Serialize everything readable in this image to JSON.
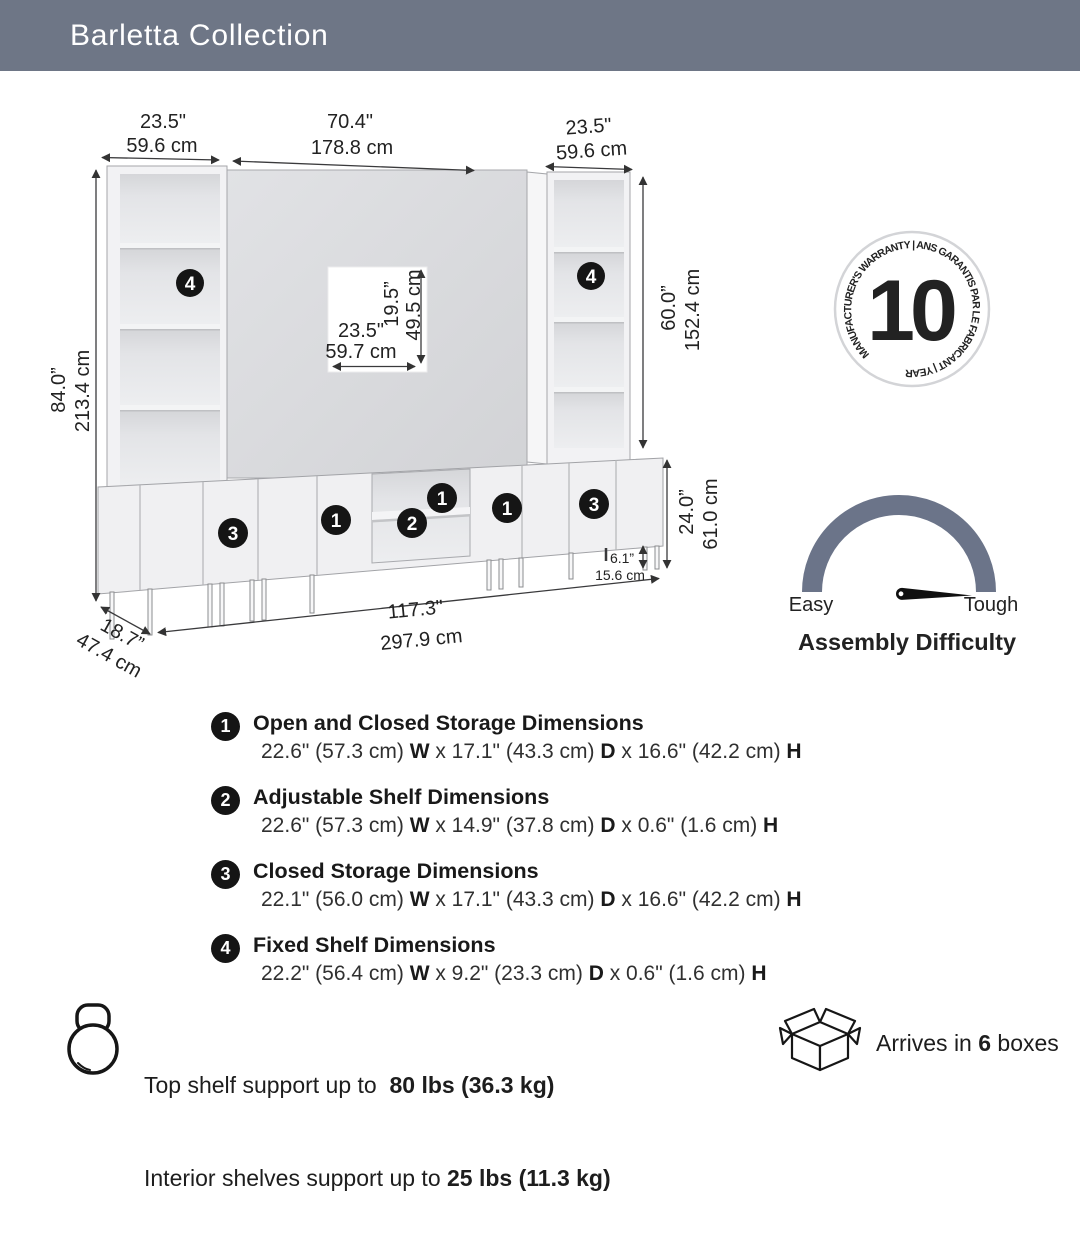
{
  "header": {
    "title": "Barletta Collection"
  },
  "diagram": {
    "dims": {
      "left_width": {
        "in": "23.5\"",
        "cm": "59.6 cm"
      },
      "center_width": {
        "in": "70.4\"",
        "cm": "178.8 cm"
      },
      "right_width": {
        "in": "23.5\"",
        "cm": "59.6 cm"
      },
      "total_height": {
        "in": "84.0”",
        "cm": "213.4 cm"
      },
      "tv_width": {
        "in": "23.5\"",
        "cm": "59.7 cm"
      },
      "tv_height": {
        "in": "19.5”",
        "cm": "49.5 cm"
      },
      "right_tower_height": {
        "in": "60.0”",
        "cm": "152.4 cm"
      },
      "console_height": {
        "in": "24.0”",
        "cm": "61.0 cm"
      },
      "leg_height": {
        "in": "6.1”",
        "cm": "15.6 cm"
      },
      "total_width": {
        "in": "117.3\"",
        "cm": "297.9 cm"
      },
      "depth": {
        "in": "18.7”",
        "cm": "47.4 cm"
      }
    },
    "callouts": {
      "c1": "1",
      "c2": "2",
      "c3": "3",
      "c4": "4"
    }
  },
  "warranty": {
    "years": "10",
    "ring_text": "MANUFACTURER'S WARRANTY  |  ANS GARANTIS PAR LE FABRICANT  |  YEAR"
  },
  "gauge": {
    "easy": "Easy",
    "tough": "Tough",
    "title": "Assembly Difficulty"
  },
  "specs": {
    "items": [
      {
        "num": "1",
        "title": "Open and Closed Storage Dimensions",
        "detail": [
          "22.6\" (57.3 cm) ",
          "W",
          " x 17.1\" (43.3 cm) ",
          "D",
          " x 16.6\" (42.2 cm) ",
          "H"
        ]
      },
      {
        "num": "2",
        "title": "Adjustable Shelf Dimensions",
        "detail": [
          "22.6\" (57.3 cm) ",
          "W",
          " x 14.9\" (37.8 cm) ",
          "D",
          " x 0.6\" (1.6 cm) ",
          "H"
        ]
      },
      {
        "num": "3",
        "title": "Closed Storage Dimensions",
        "detail": [
          "22.1\" (56.0 cm) ",
          "W",
          " x 17.1\" (43.3 cm) ",
          "D",
          " x 16.6\" (42.2 cm) ",
          "H"
        ]
      },
      {
        "num": "4",
        "title": "Fixed Shelf Dimensions",
        "detail": [
          "22.2\" (56.4 cm) ",
          "W",
          " x 9.2\" (23.3 cm) ",
          "D",
          " x 0.6\" (1.6 cm) ",
          "H"
        ]
      }
    ]
  },
  "footer": {
    "weight_line1": [
      "Top shelf support up to  ",
      "80 lbs (36.3 kg)"
    ],
    "weight_line2": [
      "Interior shelves support up to ",
      "25 lbs (11.3 kg)"
    ],
    "boxes": [
      "Arrives in ",
      "6",
      " boxes"
    ]
  }
}
